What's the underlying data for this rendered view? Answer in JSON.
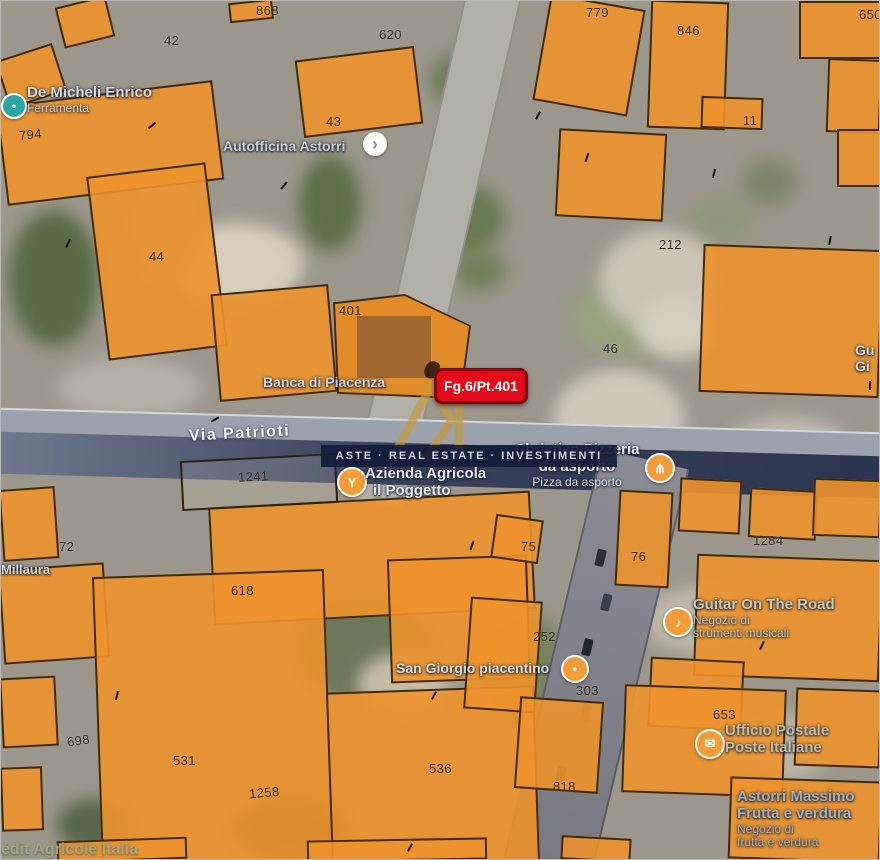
{
  "map": {
    "marker": {
      "label": "Fg.6/Pt.401"
    },
    "street_label": "Via Patrioti",
    "watermark": {
      "brand": "ASTE · REAL ESTATE · INVESTIMENTI",
      "monogram": "R"
    },
    "pois": {
      "de_micheli": {
        "name": "De Micheli Enrico",
        "subtitle": "Ferramenta"
      },
      "autofficina": {
        "name": "Autofficina Astorri"
      },
      "banca": {
        "name": "Banca di Piacenza"
      },
      "pizzeria": {
        "line1": "Christian Pizzeria",
        "line2": "da asporto",
        "subtitle": "Pizza da asporto"
      },
      "azienda": {
        "line1": "Azienda Agricola",
        "line2": "il Poggetto"
      },
      "san_giorgio": {
        "name": "San Giorgio piacentino"
      },
      "guitar": {
        "name": "Guitar On The Road",
        "sub1": "Negozio di",
        "sub2": "strumenti musicali"
      },
      "poste": {
        "line1": "Ufficio Postale",
        "line2": "Poste Italiane"
      },
      "astorri": {
        "line1": "Astorri Massimo",
        "line2": "Frutta e verdura",
        "sub1": "Negozio di",
        "sub2": "frutta e verdura"
      },
      "millaura": {
        "name": "Millaura"
      },
      "credit_agricole": {
        "name": "édit Agricole Italia"
      },
      "partial_right": {
        "line1": "Gu",
        "line2": "Gi"
      }
    },
    "parcel_numbers": [
      "868",
      "620",
      "42",
      "43",
      "779",
      "846",
      "650",
      "11",
      "794",
      "44",
      "401",
      "212",
      "46",
      "1241",
      "72",
      "75",
      "76",
      "1284",
      "618",
      "252",
      "303",
      "698",
      "531",
      "1258",
      "536",
      "818",
      "653"
    ],
    "icons": {
      "restaurant_pin_glyph": "⋔",
      "agricola_pin_glyph": "Y",
      "post_pin_glyph": "✉",
      "music_pin_glyph": "♪",
      "chevron_glyph": "›",
      "dot_glyph": "•"
    },
    "colors": {
      "parcel_orange": "#ED922B",
      "marker_red": "#E30B17",
      "watermark_navy": "#131C38",
      "watermark_gold": "#C49A3F",
      "pin_orange": "#F29C38",
      "pin_teal": "#2AA7A0"
    }
  }
}
